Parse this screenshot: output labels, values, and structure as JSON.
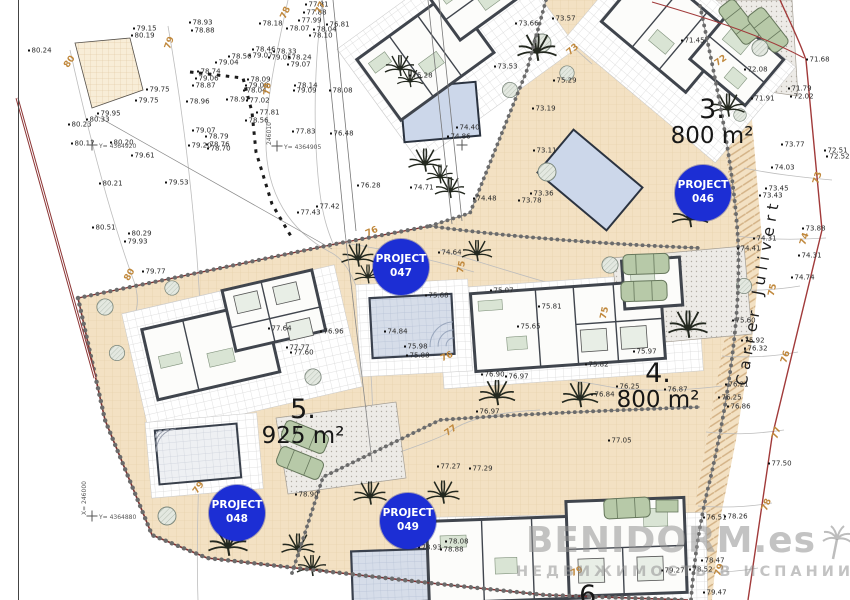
{
  "street_label": "Carrer Julivert",
  "watermark": {
    "title": "BENIDORM.es",
    "subtitle": "НЕДВИЖИМОСТЬ В ИСПАНИИ"
  },
  "plot_labels": [
    {
      "number": "3.",
      "area": "800 m²",
      "x": 712,
      "y": 96
    },
    {
      "number": "4.",
      "area": "800 m²",
      "x": 658,
      "y": 360
    },
    {
      "number": "5.",
      "area": "925 m²",
      "x": 303,
      "y": 396
    },
    {
      "number": "6.",
      "area": "",
      "x": 592,
      "y": 582
    }
  ],
  "project_badges": [
    {
      "line1": "PROJECT",
      "line2": "046",
      "x": 703,
      "y": 193
    },
    {
      "line1": "PROJECT",
      "line2": "047",
      "x": 401,
      "y": 267
    },
    {
      "line1": "PROJECT",
      "line2": "048",
      "x": 237,
      "y": 513
    },
    {
      "line1": "PROJECT",
      "line2": "049",
      "x": 408,
      "y": 521
    }
  ],
  "contour_labels": [
    [
      "80",
      70,
      62,
      -55
    ],
    [
      "79",
      170,
      43,
      -70
    ],
    [
      "78",
      286,
      13,
      -65
    ],
    [
      "77",
      321,
      8,
      -65
    ],
    [
      "78",
      268,
      89,
      -85
    ],
    [
      "80",
      130,
      275,
      -60
    ],
    [
      "79",
      199,
      488,
      -55
    ],
    [
      "73",
      573,
      50,
      -40
    ],
    [
      "72",
      721,
      61,
      -35
    ],
    [
      "73",
      818,
      178,
      -72
    ],
    [
      "74",
      805,
      239,
      -72
    ],
    [
      "75",
      773,
      290,
      -78
    ],
    [
      "76",
      786,
      357,
      -72
    ],
    [
      "77",
      777,
      433,
      -72
    ],
    [
      "78",
      767,
      505,
      -68
    ],
    [
      "79",
      720,
      570,
      -70
    ],
    [
      "76",
      372,
      232,
      -25
    ],
    [
      "75",
      462,
      267,
      -80
    ],
    [
      "76",
      447,
      357,
      -25
    ],
    [
      "75",
      605,
      313,
      -78
    ],
    [
      "77",
      451,
      431,
      -35
    ],
    [
      "79",
      577,
      572,
      -25
    ]
  ],
  "survey_crosses": [
    {
      "x": 92,
      "y": 145,
      "label": "Y= 4364920",
      "vlabel": ""
    },
    {
      "x": 277,
      "y": 146,
      "label": "Y= 4364905",
      "vlabel": "246010"
    },
    {
      "x": 462,
      "y": 145,
      "label": "",
      "vlabel": ""
    },
    {
      "x": 92,
      "y": 516,
      "label": "Y= 4364880",
      "vlabel": "X= 246000"
    }
  ],
  "elevation_points": [
    [
      "80.24",
      28,
      51
    ],
    [
      "79.15",
      133,
      29
    ],
    [
      "80.19",
      131,
      36
    ],
    [
      "79.75",
      146,
      90
    ],
    [
      "79.75",
      135,
      101
    ],
    [
      "79.95",
      97,
      114
    ],
    [
      "80.33",
      86,
      120
    ],
    [
      "80.23",
      68,
      125
    ],
    [
      "80.17",
      71,
      144
    ],
    [
      "80.20",
      110,
      143
    ],
    [
      "79.61",
      131,
      156
    ],
    [
      "80.21",
      99,
      184
    ],
    [
      "79.53",
      165,
      183
    ],
    [
      "80.51",
      92,
      228
    ],
    [
      "80.29",
      128,
      234
    ],
    [
      "79.93",
      124,
      242
    ],
    [
      "79.77",
      142,
      272
    ],
    [
      "78.93",
      189,
      23
    ],
    [
      "78.88",
      191,
      31
    ],
    [
      "78.18",
      259,
      24
    ],
    [
      "77.81",
      305,
      5
    ],
    [
      "77.88",
      303,
      13
    ],
    [
      "77.99",
      298,
      21
    ],
    [
      "78.07",
      286,
      29
    ],
    [
      "78.04",
      313,
      30
    ],
    [
      "78.10",
      309,
      36
    ],
    [
      "76.81",
      326,
      25
    ],
    [
      "78.46",
      252,
      50
    ],
    [
      "79.07",
      249,
      56
    ],
    [
      "78.33",
      273,
      52
    ],
    [
      "79.05",
      268,
      58
    ],
    [
      "78.24",
      288,
      58
    ],
    [
      "79.07",
      287,
      65
    ],
    [
      "78.56",
      228,
      57
    ],
    [
      "79.04",
      215,
      63
    ],
    [
      "78.74",
      197,
      72
    ],
    [
      "79.06",
      195,
      79
    ],
    [
      "78.87",
      192,
      86
    ],
    [
      "78.96",
      186,
      102
    ],
    [
      "78.09",
      247,
      80
    ],
    [
      "79.08",
      245,
      86
    ],
    [
      "78.04",
      243,
      91
    ],
    [
      "78.14",
      294,
      86
    ],
    [
      "79.09",
      293,
      91
    ],
    [
      "78.08",
      329,
      91
    ],
    [
      "78.97",
      226,
      100
    ],
    [
      "77.02",
      246,
      101
    ],
    [
      "77.81",
      256,
      113
    ],
    [
      "78.56",
      245,
      121
    ],
    [
      "77.83",
      292,
      132
    ],
    [
      "76.48",
      330,
      134
    ],
    [
      "79.07",
      192,
      131
    ],
    [
      "78.79",
      205,
      137
    ],
    [
      "78.76",
      206,
      145
    ],
    [
      "79.20",
      188,
      146
    ],
    [
      "78.70",
      207,
      149
    ],
    [
      "77.43",
      297,
      213
    ],
    [
      "77.42",
      316,
      207
    ],
    [
      "76.28",
      357,
      186
    ],
    [
      "73.66",
      515,
      24
    ],
    [
      "73.57",
      552,
      19
    ],
    [
      "73.53",
      494,
      67
    ],
    [
      "75.28",
      409,
      76
    ],
    [
      "75.29",
      553,
      81
    ],
    [
      "73.19",
      532,
      109
    ],
    [
      "73.11",
      533,
      151
    ],
    [
      "73.36",
      530,
      194
    ],
    [
      "73.78",
      518,
      201
    ],
    [
      "74.48",
      473,
      199
    ],
    [
      "74.71",
      410,
      188
    ],
    [
      "74.86",
      447,
      137
    ],
    [
      "74.40",
      456,
      128
    ],
    [
      "71.45",
      681,
      41
    ],
    [
      "72.08",
      744,
      70
    ],
    [
      "71.68",
      806,
      60
    ],
    [
      "71.79",
      788,
      89
    ],
    [
      "72.02",
      790,
      97
    ],
    [
      "71.91",
      751,
      99
    ],
    [
      "73.77",
      781,
      145
    ],
    [
      "72.51",
      824,
      151
    ],
    [
      "72.52",
      826,
      157
    ],
    [
      "74.03",
      771,
      168
    ],
    [
      "73.45",
      765,
      189
    ],
    [
      "73.43",
      759,
      196
    ],
    [
      "73.88",
      802,
      229
    ],
    [
      "74.31",
      798,
      256
    ],
    [
      "74.74",
      791,
      278
    ],
    [
      "74.31",
      753,
      239
    ],
    [
      "74.41",
      737,
      249
    ],
    [
      "75.60",
      732,
      321
    ],
    [
      "75.92",
      741,
      341
    ],
    [
      "76.32",
      744,
      349
    ],
    [
      "76.21",
      725,
      385
    ],
    [
      "76.25",
      718,
      398
    ],
    [
      "76.86",
      727,
      407
    ],
    [
      "77.50",
      768,
      464
    ],
    [
      "74.64",
      438,
      253
    ],
    [
      "75.68",
      425,
      296
    ],
    [
      "75.98",
      404,
      347
    ],
    [
      "75.88",
      406,
      356
    ],
    [
      "74.84",
      384,
      332
    ],
    [
      "75.07",
      490,
      291
    ],
    [
      "75.81",
      538,
      307
    ],
    [
      "75.65",
      517,
      327
    ],
    [
      "75.82",
      585,
      365
    ],
    [
      "75.97",
      633,
      352
    ],
    [
      "76.90",
      481,
      375
    ],
    [
      "76.97",
      505,
      377
    ],
    [
      "76.25",
      616,
      387
    ],
    [
      "76.84",
      591,
      395
    ],
    [
      "76.87",
      664,
      390
    ],
    [
      "76.97",
      476,
      412
    ],
    [
      "77.05",
      608,
      441
    ],
    [
      "77.64",
      268,
      329
    ],
    [
      "77.77",
      286,
      348
    ],
    [
      "77.60",
      290,
      353
    ],
    [
      "76.96",
      320,
      332
    ],
    [
      "78.90",
      295,
      495
    ],
    [
      "78.08",
      445,
      542
    ],
    [
      "78.93",
      418,
      548
    ],
    [
      "78.88",
      440,
      550
    ],
    [
      "77.29",
      469,
      469
    ],
    [
      "77.27",
      437,
      467
    ],
    [
      "79.27",
      661,
      571
    ],
    [
      "78.52",
      689,
      570
    ],
    [
      "78.26",
      724,
      517
    ],
    [
      "76.51",
      703,
      518
    ],
    [
      "78.47",
      701,
      561
    ],
    [
      "79.47",
      703,
      593
    ]
  ],
  "colors": {
    "badge_blue": "#1c2ed4",
    "plot_fill": "#f3e1c3",
    "contour_label": "#c0883c",
    "boundary_red": "#8c3434",
    "pool_blue": "#ccd7ea",
    "watermark_gray": "#919191"
  }
}
